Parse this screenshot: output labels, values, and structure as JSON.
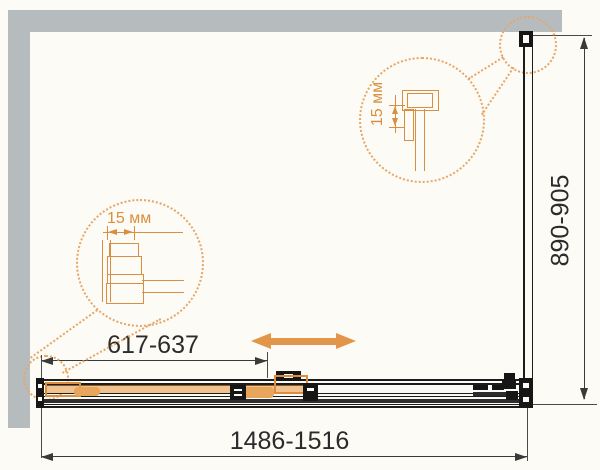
{
  "dimensions": {
    "overall_width": "1486-1516",
    "door_width": "617-637",
    "side_depth": "890-905"
  },
  "callouts": {
    "left_detail": {
      "label": "15 мм"
    },
    "right_detail": {
      "label": "15 мм"
    }
  },
  "icons": {
    "slide_direction": "double-arrow-horizontal-icon",
    "detail_zoom": "magnifier-callout-circle"
  },
  "colors": {
    "accent_orange": "#D98F3F",
    "accent_orange_fill": "#E8A55C",
    "arrow_orange": "#E2964A",
    "wall_gray": "#B6BCBE",
    "line_black": "#1C1C1C",
    "background": "#FCFBF5"
  }
}
